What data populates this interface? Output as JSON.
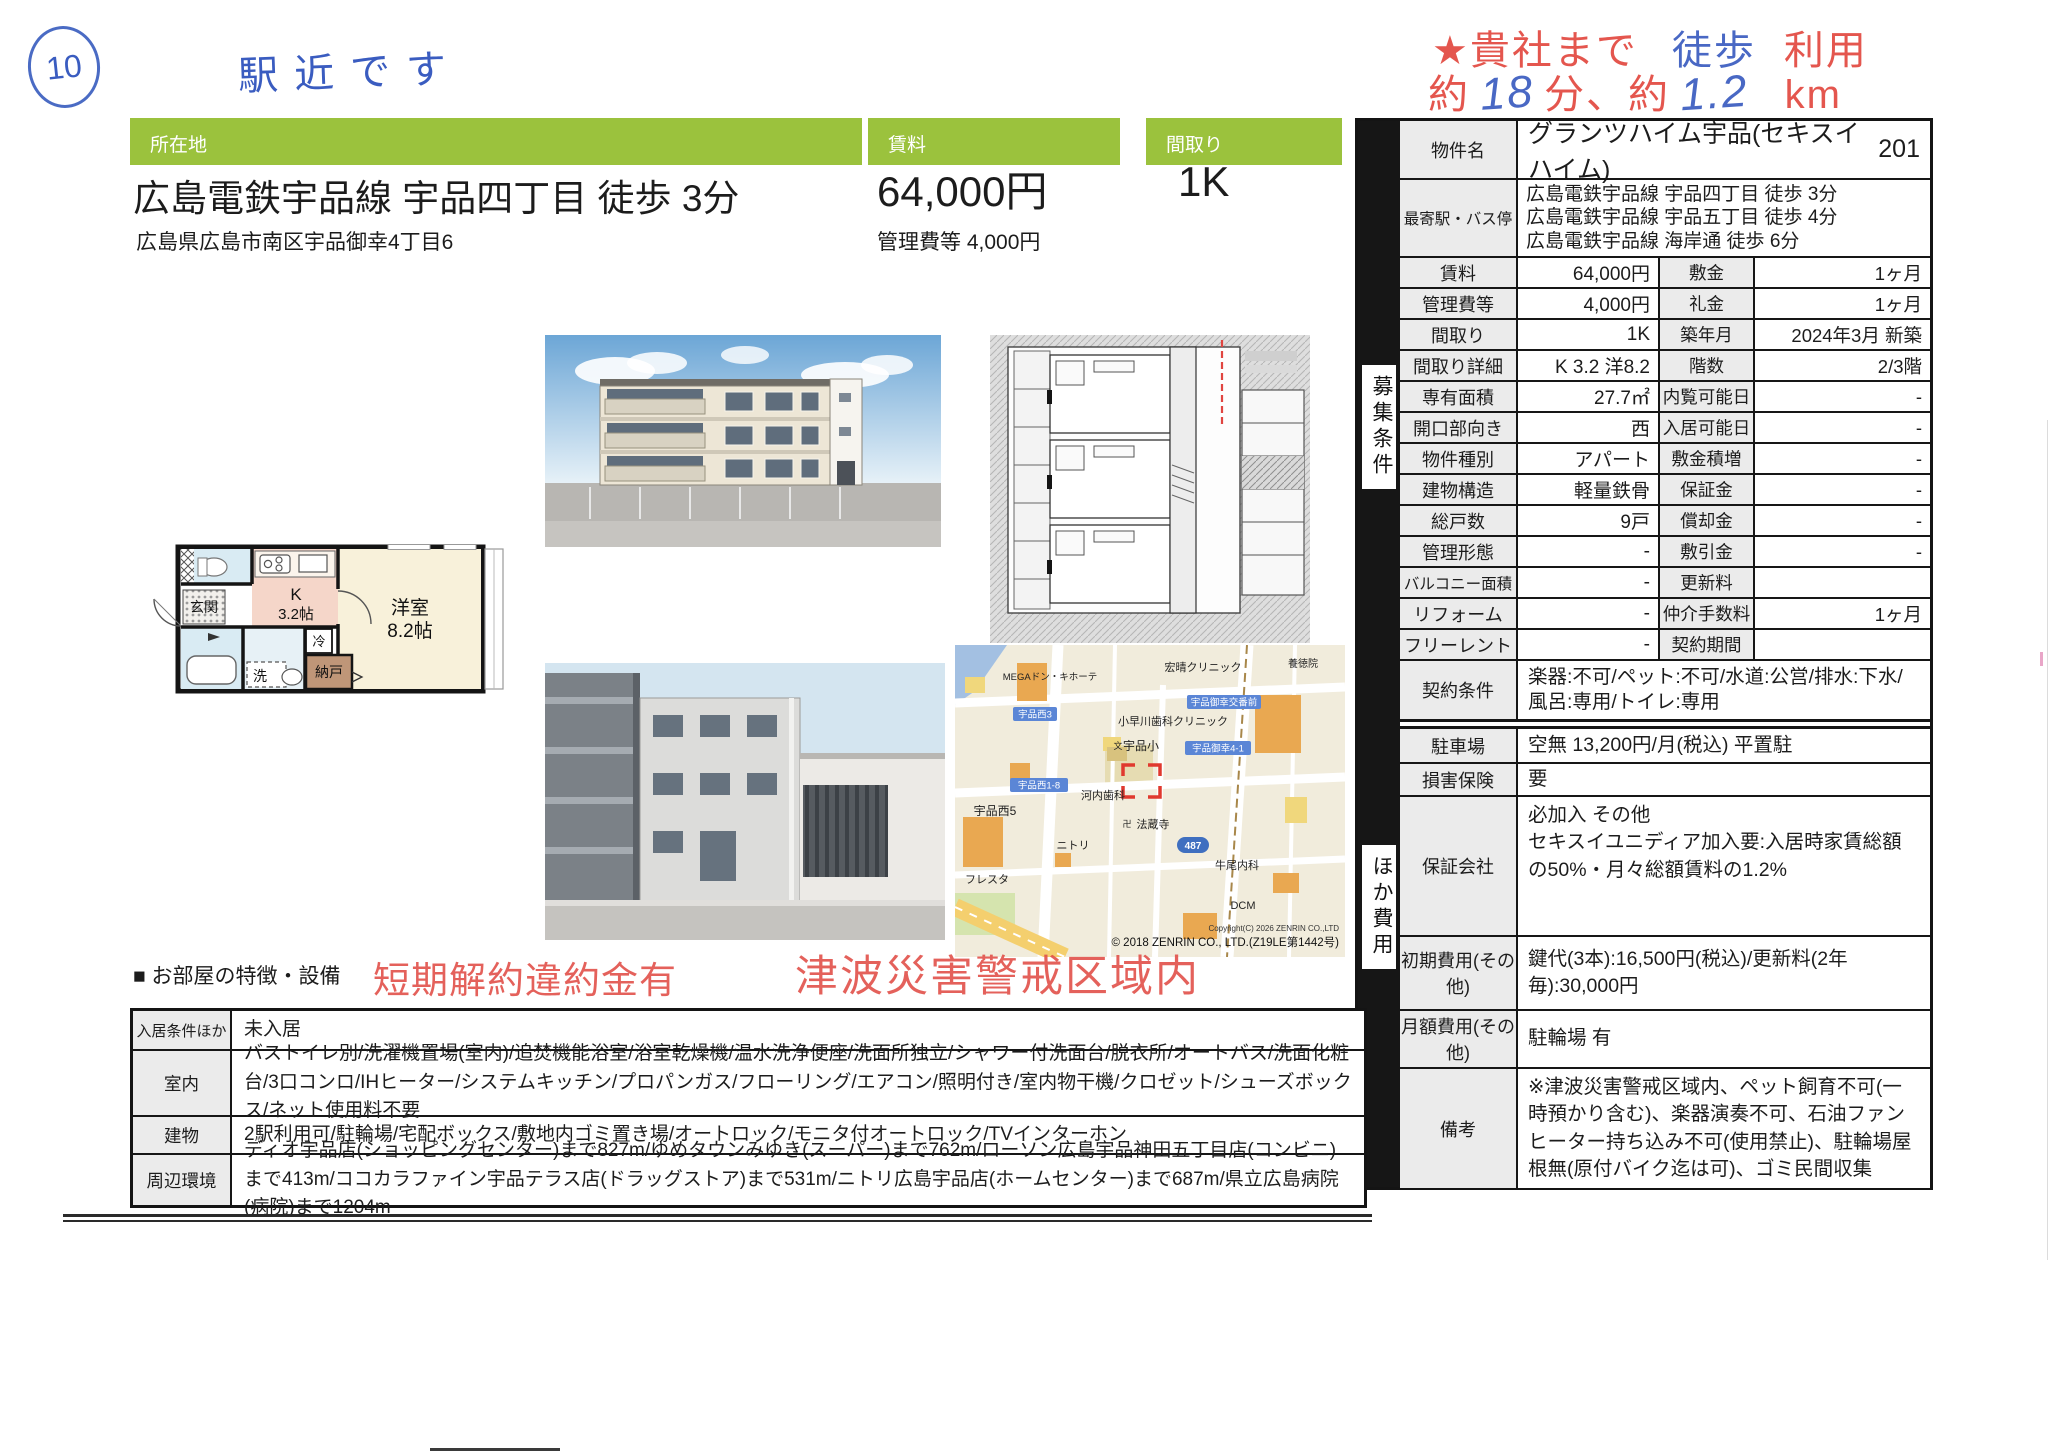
{
  "page": {
    "circle_number": "10",
    "handwritten_note": "駅近です"
  },
  "top_stamp": {
    "line1_red1": "★貴社まで",
    "line1_blue": "徒歩",
    "line1_red2": "利用",
    "line2_red1": "約",
    "line2_blue1": "18",
    "line2_red2": "分、約",
    "line2_blue2": "1.2",
    "line2_red3": "km"
  },
  "headers": {
    "location_label": "所在地",
    "rent_label": "賃料",
    "layout_label": "間取り"
  },
  "summary": {
    "station_line": "広島電鉄宇品線 宇品四丁目 徒歩 3分",
    "address": "広島県広島市南区宇品御幸4丁目6",
    "rent": "64,000円",
    "management_fee": "管理費等 4,000円",
    "layout": "1K"
  },
  "stamps": {
    "short_term": "短期解約違約金有",
    "tsunami": "津波災害警戒区域内"
  },
  "rails": {
    "recruit": "募集条件",
    "other_fees": "ほか費用"
  },
  "spec_table": {
    "property_name_label": "物件名",
    "property_name": "グランツハイム宇品(セキスイハイム)",
    "room_no": "201",
    "station_label": "最寄駅・バス停",
    "stations": [
      "広島電鉄宇品線 宇品四丁目 徒歩 3分",
      "広島電鉄宇品線 宇品五丁目 徒歩 4分",
      "広島電鉄宇品線 海岸通 徒歩 6分"
    ],
    "rows": [
      {
        "l1": "賃料",
        "v1": "64,000円",
        "l2": "敷金",
        "v2": "1ヶ月"
      },
      {
        "l1": "管理費等",
        "v1": "4,000円",
        "l2": "礼金",
        "v2": "1ヶ月"
      },
      {
        "l1": "間取り",
        "v1": "1K",
        "l2": "築年月",
        "v2": "2024年3月 新築"
      },
      {
        "l1": "間取り詳細",
        "v1": "K 3.2 洋8.2",
        "l2": "階数",
        "v2": "2/3階"
      },
      {
        "l1": "専有面積",
        "v1": "27.7㎡",
        "l2": "内覧可能日",
        "v2": "-"
      },
      {
        "l1": "開口部向き",
        "v1": "西",
        "l2": "入居可能日",
        "v2": "-"
      },
      {
        "l1": "物件種別",
        "v1": "アパート",
        "l2": "敷金積増",
        "v2": "-"
      },
      {
        "l1": "建物構造",
        "v1": "軽量鉄骨",
        "l2": "保証金",
        "v2": "-"
      },
      {
        "l1": "総戸数",
        "v1": "9戸",
        "l2": "償却金",
        "v2": "-"
      },
      {
        "l1": "管理形態",
        "v1": "-",
        "l2": "敷引金",
        "v2": "-"
      },
      {
        "l1": "バルコニー面積",
        "v1": "-",
        "l2": "更新料",
        "v2": ""
      },
      {
        "l1": "リフォーム",
        "v1": "-",
        "l2": "仲介手数料",
        "v2": "1ヶ月"
      },
      {
        "l1": "フリーレント",
        "v1": "-",
        "l2": "契約期間",
        "v2": ""
      }
    ],
    "contract_label": "契約条件",
    "contract_value": "楽器:不可/ペット:不可/水道:公営/排水:下水/風呂:専用/トイレ:専用"
  },
  "fees_table": {
    "rows": [
      {
        "label": "駐車場",
        "value": "空無 13,200円/月(税込) 平置駐"
      },
      {
        "label": "損害保険",
        "value": "要"
      },
      {
        "label": "保証会社",
        "value": "必加入 その他\nセキスイユニディア加入要:入居時家賃総額の50%・月々総額賃料の1.2%"
      },
      {
        "label": "初期費用(その他)",
        "value": "鍵代(3本):16,500円(税込)/更新料(2年毎):30,000円"
      },
      {
        "label": "月額費用(その他)",
        "value": "駐輪場 有"
      },
      {
        "label": "備考",
        "value": "※津波災害警戒区域内、ペット飼育不可(一時預かり含む)、楽器演奏不可、石油ファンヒーター持ち込み不可(使用禁止)、駐輪場屋根無(原付バイク迄は可)、ゴミ民間収集"
      }
    ]
  },
  "features": {
    "title": "■ お部屋の特徴・設備",
    "rows": [
      {
        "label": "入居条件ほか",
        "value": "未入居"
      },
      {
        "label": "室内",
        "value": "バストイレ別/洗濯機置場(室内)/追焚機能浴室/浴室乾燥機/温水洗浄便座/洗面所独立/シャワー付洗面台/脱衣所/オートバス/洗面化粧台/3口コンロ/IHヒーター/システムキッチン/プロパンガス/フローリング/エアコン/照明付き/室内物干機/クロゼット/シューズボックス/ネット使用料不要"
      },
      {
        "label": "建物",
        "value": "2駅利用可/駐輪場/宅配ボックス/敷地内ゴミ置き場/オートロック/モニタ付オートロック/TVインターホン"
      },
      {
        "label": "周辺環境",
        "value": "ディオ宇品店(ショッピングセンター)まで827m/ゆめタウンみゆき(スーパー)まで762m/ローソン広島宇品神田五丁目店(コンビニ)まで413m/ココカラファイン宇品テラス店(ドラッグストア)まで531m/ニトリ広島宇品店(ホームセンター)まで687m/県立広島病院(病院)まで1204m"
      }
    ]
  },
  "floorplan": {
    "genkan": "玄関",
    "kitchen_label": "K",
    "kitchen_size": "3.2帖",
    "room_label": "洋室",
    "room_size": "8.2帖",
    "fridge": "冷",
    "washer": "洗",
    "storage": "納戸"
  },
  "map": {
    "pois": [
      {
        "text": "MEGAドン・キホーテ"
      },
      {
        "text": "宏晴クリニック"
      },
      {
        "text": "養徳院"
      },
      {
        "text": "小早川歯科クリニック"
      },
      {
        "text": "宇品小"
      },
      {
        "text": "河内歯科"
      },
      {
        "text": "宇品西5"
      },
      {
        "text": "法蔵寺"
      },
      {
        "text": "ニトリ"
      },
      {
        "text": "牛尾内科"
      },
      {
        "text": "フレスタ"
      },
      {
        "text": "DCM"
      }
    ],
    "pills": [
      {
        "text": "宇品西3"
      },
      {
        "text": "宇品御幸交番前"
      },
      {
        "text": "宇品御幸4-1"
      },
      {
        "text": "宇品西1-8"
      }
    ],
    "school_mark": "文",
    "temple_mark": "卍",
    "route_shield": "487",
    "copyright_small": "Copyright(C) 2026 ZENRIN CO.,LTD",
    "copyright_large": "© 2018 ZENRIN CO., LTD.(Z19LE第1442号)"
  },
  "colors": {
    "accent_green": "#9bc23d",
    "stamp_red": "#e2514a",
    "handwriting_blue": "#3a5cc0",
    "table_label_gray": "#ebebeb"
  }
}
